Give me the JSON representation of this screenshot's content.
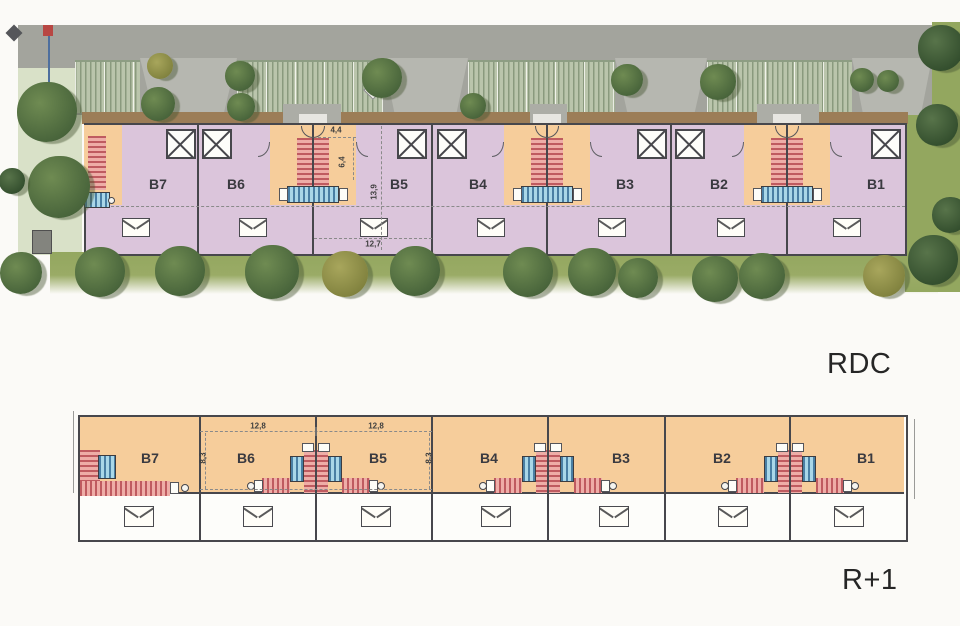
{
  "plans": {
    "rdc": {
      "label": "RDC",
      "units": [
        "B7",
        "B6",
        "B5",
        "B4",
        "B3",
        "B2",
        "B1"
      ],
      "dimensions": [
        "4,4",
        "6,4",
        "13,9",
        "12,7"
      ]
    },
    "r1": {
      "label": "R+1",
      "units": [
        "B7",
        "B6",
        "B5",
        "B4",
        "B3",
        "B2",
        "B1"
      ],
      "dimensions": [
        "12,8",
        "12,8",
        "8,3",
        "8,3"
      ]
    }
  },
  "colors": {
    "room_pink": "#dbc5db",
    "entry_orange": "#f6cd9b",
    "stair_red": "#bf5b60",
    "stair_blue": "#a9d7e8",
    "lawn_green": "#93a75f",
    "road_gray": "#a3a49d",
    "path_brown": "#9c7d57"
  },
  "icons": {
    "tree": "green-blob",
    "rooflight": "square-with-x",
    "roof_window": "rect-with-v",
    "flag": "red-flag-on-pole",
    "marker": "diamond"
  }
}
